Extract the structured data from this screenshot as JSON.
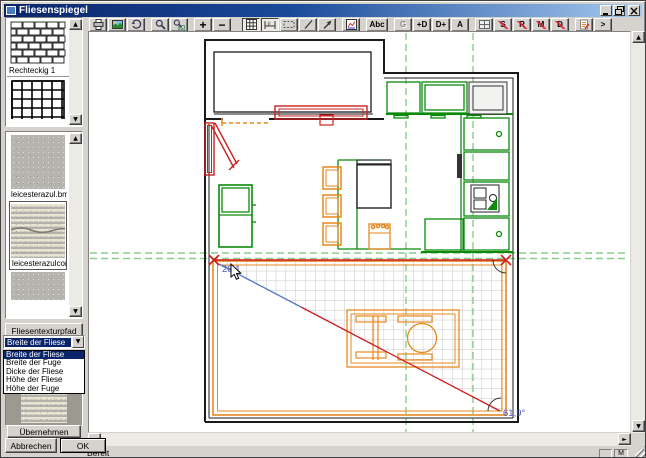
{
  "window": {
    "title": "Fliesenspiegel"
  },
  "icons": {
    "up": "▲",
    "down": "▼",
    "left": "◄",
    "right": "►"
  },
  "toolbar": {
    "plus": "+",
    "minus": "−",
    "abc": "Abc",
    "g": "G",
    "plus_d": "+D",
    "d_plus": "D+",
    "a": "A",
    "s": "S",
    "r": "R",
    "m": "M",
    "d": "D",
    "more": ">"
  },
  "sidebar": {
    "pattern_label": "Rechteckig 1",
    "texture1_label": "leicesterazul.bmp",
    "texture2_label": "leicesterazulcorte.bmp",
    "texture_path_button": "Fliesentexturpfad",
    "dropdown": {
      "value": "Breite der Fliese",
      "items": [
        "Breite der Fliese",
        "Breite der Fuge",
        "Dicke der Fliese",
        "Höhe der Fliese",
        "Höhe der Fuge"
      ]
    },
    "apply_button": "Übernehmen",
    "cancel_button": "Abbrechen",
    "ok_button": "OK"
  },
  "canvas": {
    "angle_start_label": "28,1",
    "angle_end_label": "61,9°"
  },
  "statusbar": {
    "ready": "Bereit",
    "indicator": "M"
  },
  "colors": {
    "cabinet_green": "#0b8a0b",
    "guide_green": "#8ccc8c",
    "furniture_orange": "#e8891f",
    "marker_red": "#cc2020",
    "label_blue": "#4a5fc0",
    "selection_navy": "#0a246a"
  }
}
